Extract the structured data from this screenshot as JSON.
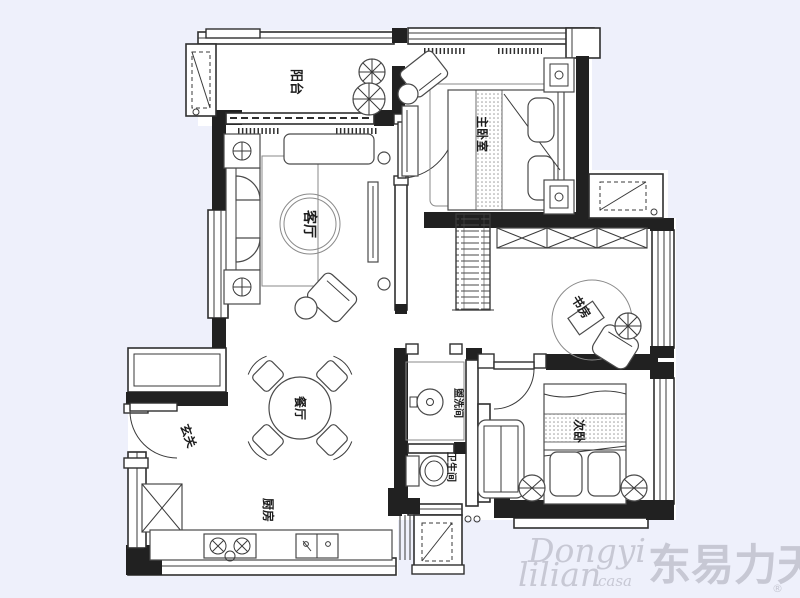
{
  "background_color": "#eef0fb",
  "plan": {
    "wall_color": "#212121",
    "line_color": "#3a3a3a",
    "floor_color": "#ffffff",
    "rooms": [
      {
        "id": "balcony",
        "label": "阳台"
      },
      {
        "id": "master-bedroom",
        "label": "主卧室"
      },
      {
        "id": "living-room",
        "label": "客厅"
      },
      {
        "id": "study",
        "label": "书房"
      },
      {
        "id": "dining-room",
        "label": "餐厅"
      },
      {
        "id": "entry",
        "label": "玄关"
      },
      {
        "id": "kitchen",
        "label": "厨房"
      },
      {
        "id": "washroom",
        "label": "盥洗间"
      },
      {
        "id": "bathroom",
        "label": "卫生间"
      },
      {
        "id": "second-bedroom",
        "label": "次卧"
      }
    ]
  },
  "watermark": {
    "script_line1": "Dongyi",
    "script_line2": "lilian",
    "script_suffix": "casa",
    "cjk": "东易力天",
    "registered": "®",
    "color": "#c7c8d4"
  }
}
